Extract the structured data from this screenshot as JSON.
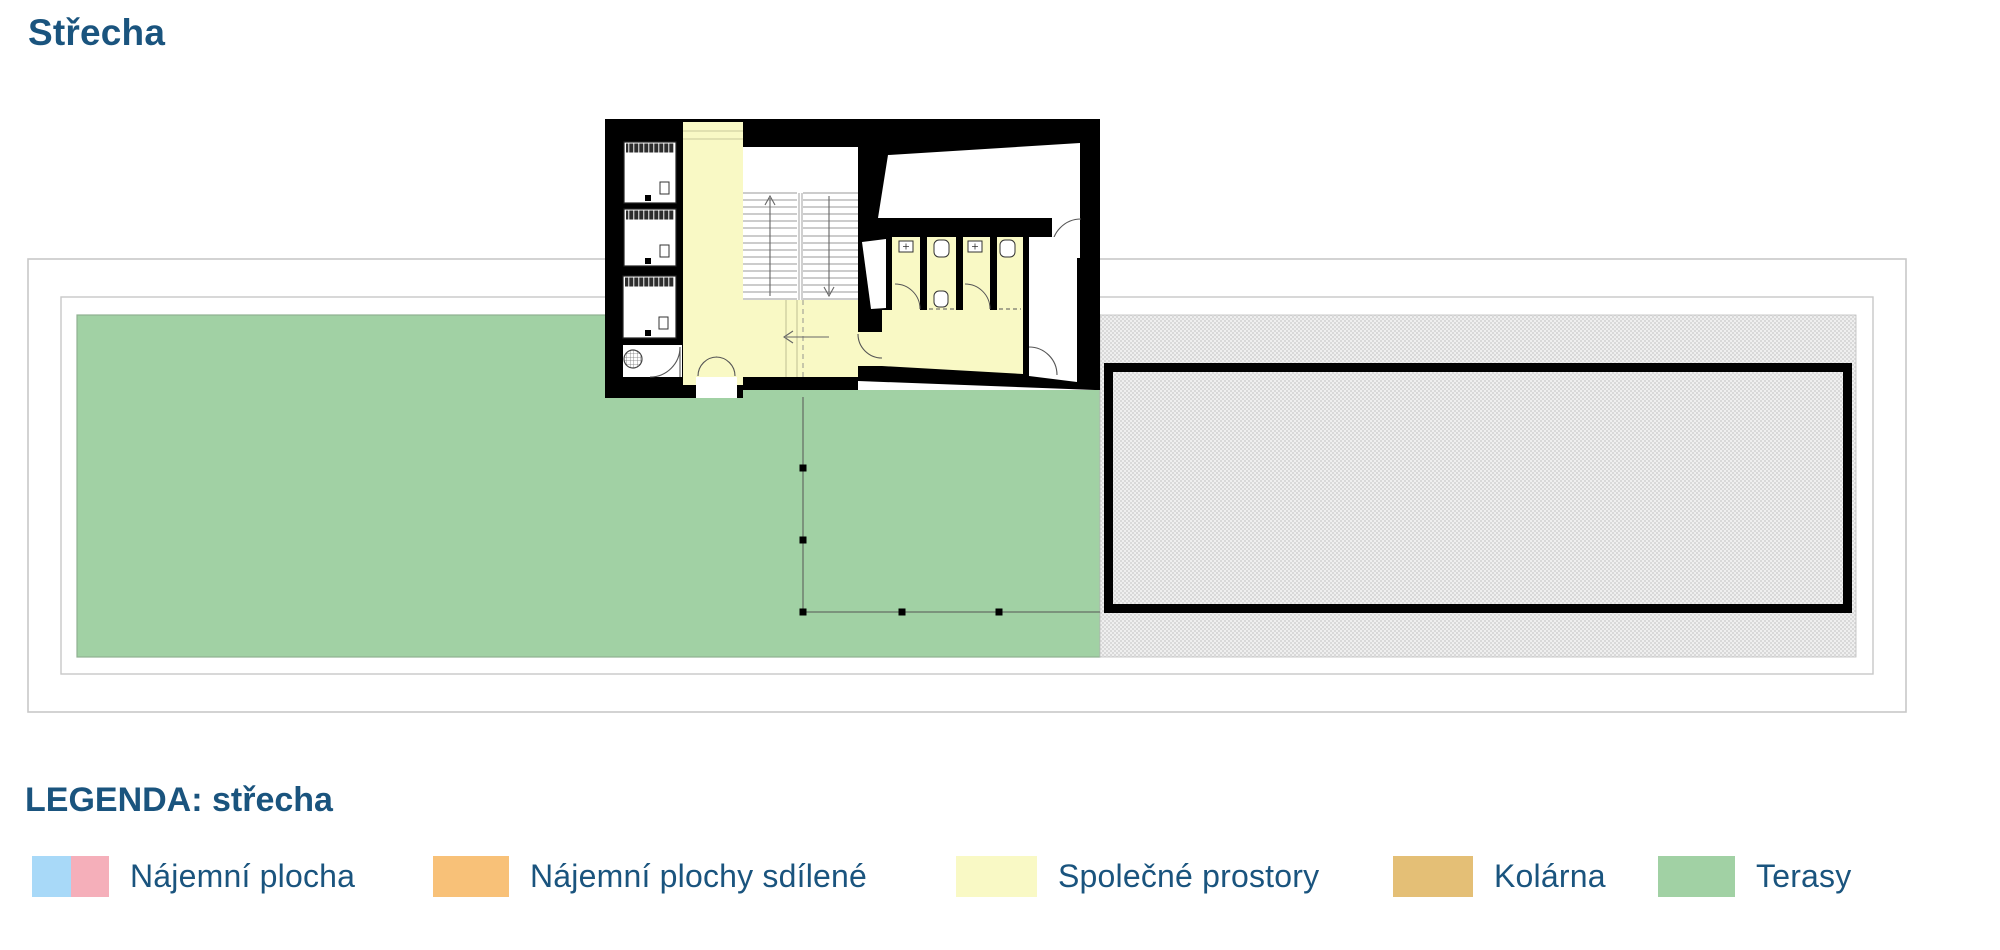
{
  "page": {
    "title": "Střecha"
  },
  "legend": {
    "heading": "LEGENDA: střecha",
    "items": [
      {
        "label": "Nájemní plocha",
        "swatch": "split-blue-pink"
      },
      {
        "label": "Nájemní plochy sdílené",
        "swatch": "orange"
      },
      {
        "label": "Společné prostory",
        "swatch": "pale-yellow"
      },
      {
        "label": "Kolárna",
        "swatch": "tan"
      },
      {
        "label": "Terasy",
        "swatch": "green"
      }
    ]
  },
  "colors": {
    "heading_text": "#1a547e",
    "terrace_green": "#a1d1a4",
    "terrace_edge": "#8fb091",
    "common_yellow": "#f9f9c5",
    "rent_blue": "#a8d9f8",
    "rent_pink": "#f5afba",
    "shared_orange": "#f8c178",
    "bike_tan": "#e4bf76",
    "wall_black": "#000000",
    "hatch_gray": "#d9d9d9",
    "hatch_base": "#efefef",
    "frame_gray": "#c8c8c8",
    "drawing_line": "#555555"
  }
}
